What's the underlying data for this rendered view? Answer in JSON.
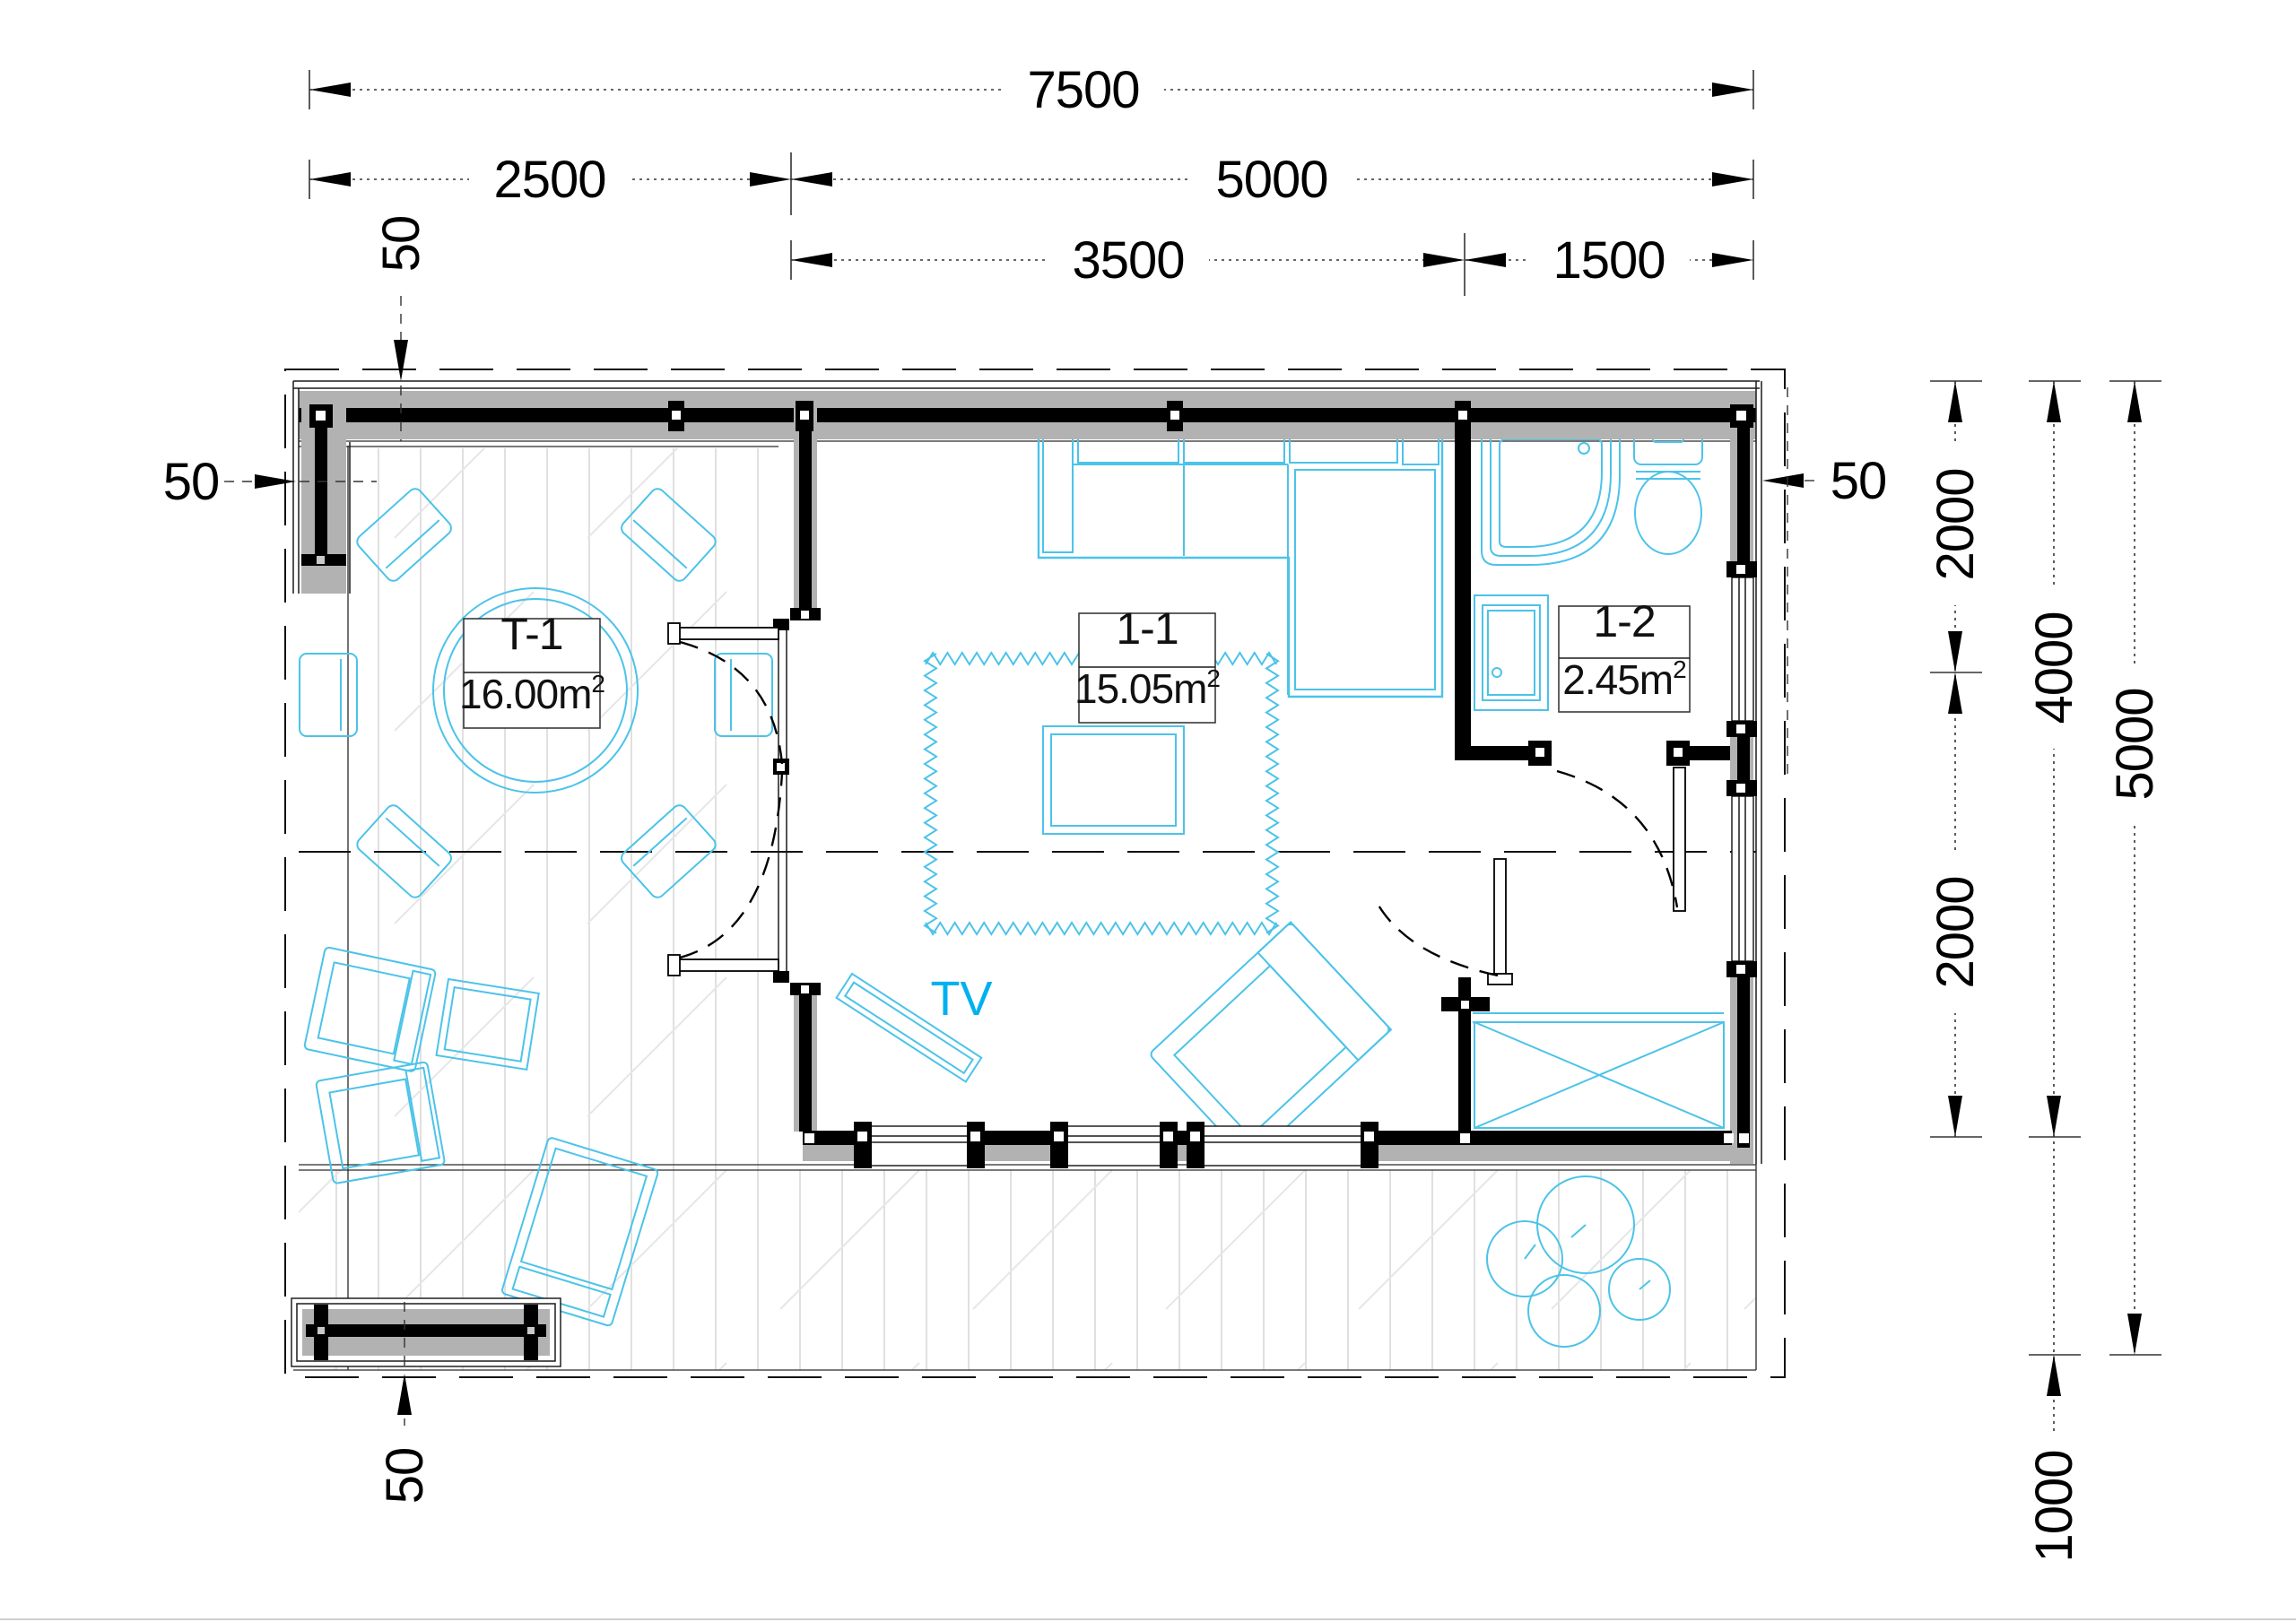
{
  "plan": {
    "tv_label": "TV",
    "rooms": [
      {
        "id": "T-1",
        "area_main": "16.00m",
        "area_sup": "2"
      },
      {
        "id": "1-1",
        "area_main": "15.05m",
        "area_sup": "2"
      },
      {
        "id": "1-2",
        "area_main": "2.45m",
        "area_sup": "2"
      }
    ]
  },
  "dimensions": {
    "top": {
      "full": "7500",
      "left": "2500",
      "right": "5000",
      "inner_left": "3500",
      "inner_right": "1500"
    },
    "right": {
      "upper": "2000",
      "lower": "2000",
      "middle": "4000",
      "total": "5000",
      "terrace": "1000"
    },
    "wall_thickness": {
      "top": "50",
      "left": "50",
      "right": "50",
      "bottom": "50"
    }
  },
  "colors": {
    "wall_fill": "#b2b2b2",
    "furniture": "#4cc3e9",
    "tv_text": "#00b1f0",
    "line": "#000000"
  }
}
